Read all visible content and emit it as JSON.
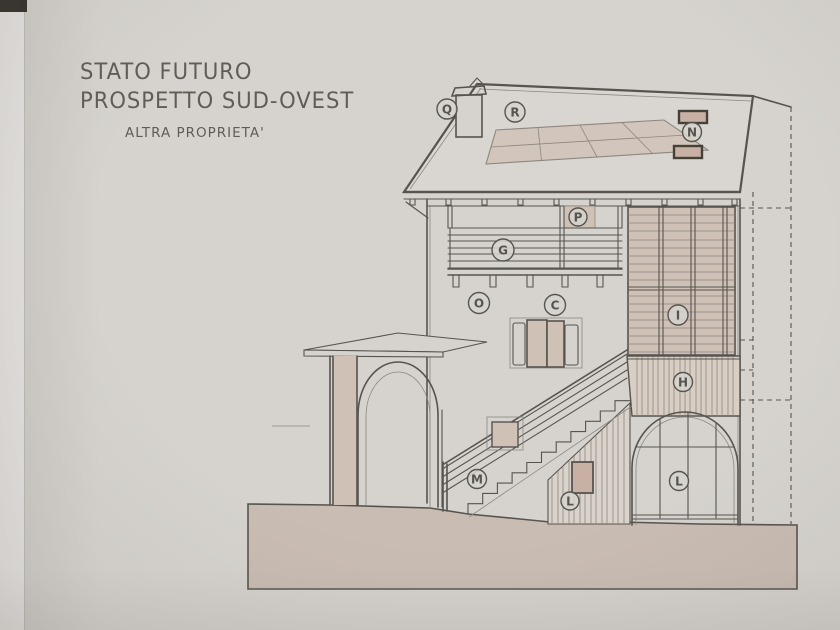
{
  "title": {
    "line1": "STATO FUTURO",
    "line2": "PROSPETTO SUD-OVEST",
    "subtitle": "ALTRA PROPRIETA'"
  },
  "labels": [
    {
      "id": "q",
      "letter": "Q"
    },
    {
      "id": "r",
      "letter": "R"
    },
    {
      "id": "n",
      "letter": "N"
    },
    {
      "id": "p",
      "letter": "P"
    },
    {
      "id": "g",
      "letter": "G"
    },
    {
      "id": "o",
      "letter": "O"
    },
    {
      "id": "c",
      "letter": "C"
    },
    {
      "id": "i",
      "letter": "I"
    },
    {
      "id": "h",
      "letter": "H"
    },
    {
      "id": "m",
      "letter": "M"
    },
    {
      "id": "l_wall",
      "letter": "L"
    },
    {
      "id": "l_arch",
      "letter": "L"
    }
  ],
  "colors": {
    "paper": "#d6d3ce",
    "paper-edge": "#eceae7",
    "line": "#57544f",
    "line-soft": "#8d8780",
    "tan": "#cfc1b6",
    "tan-light": "#d8cec4",
    "ground": "#c9bcb2",
    "dark": "#454139",
    "skylight": "#c8b1a4",
    "text": "#605d57",
    "stipple": "#c6c2bb"
  }
}
